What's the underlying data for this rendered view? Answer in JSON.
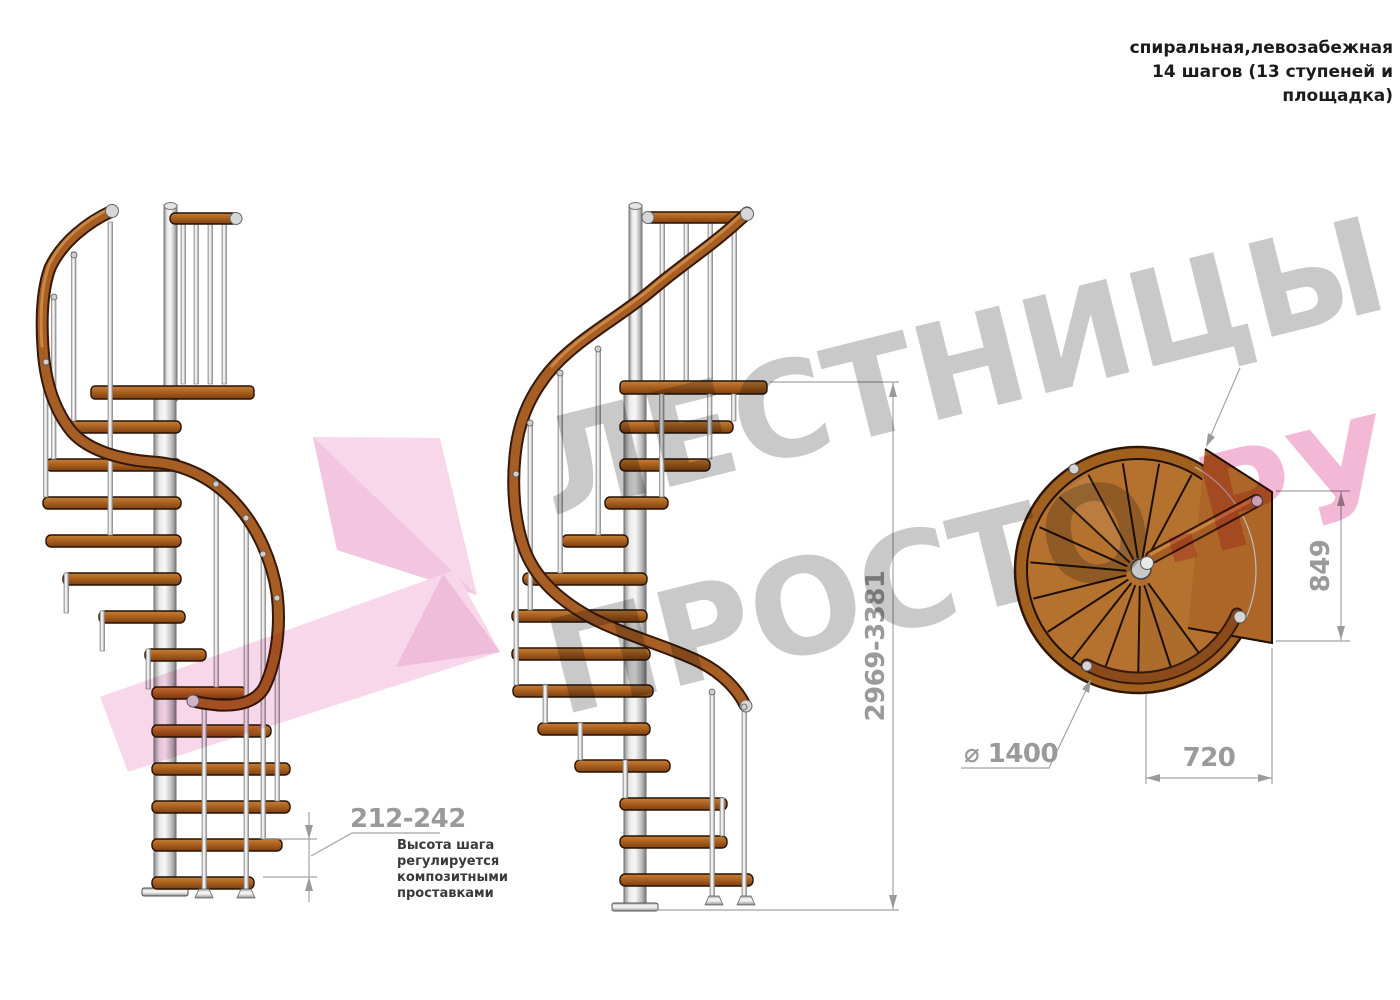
{
  "header": {
    "title_line1": "спиральная,левозабежная",
    "title_line2": "14 шагов (13 ступеней и",
    "title_line3": "площадка)"
  },
  "annotations": {
    "step_height_value": "212-242",
    "note_line1": "Высота шага",
    "note_line2": "регулируется",
    "note_line3": "композитными",
    "note_line4": "проставками",
    "total_height_value": "2969-3381",
    "landing_side_value": "849",
    "landing_width_value": "720",
    "diameter_label": "⌀ 1400"
  },
  "watermark": {
    "word1": "ЛЕСТНИЦЫ",
    "word2_gray": "ПРОСТО",
    "word2_pink": ".РУ"
  },
  "colors": {
    "wood": "#ab621f",
    "wood_top_view": "#b5722f",
    "rail": "#a75e24",
    "steel": "#d9d9d9",
    "dimension_gray": "#9a9a9a",
    "note_text": "#3a3a3a",
    "title_text": "#1b1b1b",
    "watermark_gray": "#c9c9c9",
    "watermark_pink": "#f2b8d5",
    "pink_shape_light": "#f8d7ea",
    "pink_shape_dark": "#f2c5e0"
  }
}
